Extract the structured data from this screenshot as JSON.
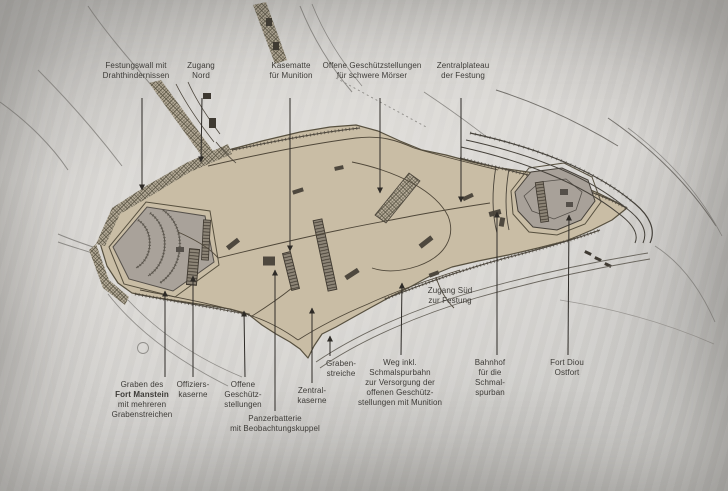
{
  "figure": {
    "kind": "annotated fortress plan",
    "colors": {
      "paper": "#d3d2cf",
      "land": "#c9bda5",
      "fort_fill": "#a8a199",
      "structure_dark": "#4e483e",
      "outline": "#57503f",
      "pointer": "#2e2b27",
      "label_text": "#3e3c38"
    }
  },
  "annotations": {
    "top": [
      {
        "id": "festungswall",
        "lines": [
          "Festungswall mit",
          "Drahthindernissen"
        ]
      },
      {
        "id": "zugang-nord",
        "lines": [
          "Zugang",
          "Nord"
        ]
      },
      {
        "id": "kasematte",
        "lines": [
          "Kasematte",
          "für Munition"
        ]
      },
      {
        "id": "offene-moerser",
        "lines": [
          "Offene Geschützstellungen",
          "für schwere Mörser"
        ]
      },
      {
        "id": "zentralplateau",
        "lines": [
          "Zentralplateau",
          "der Festung"
        ]
      }
    ],
    "bottom": [
      {
        "id": "graben-fort-manstein",
        "lines": [
          "Graben des",
          "Fort Manstein",
          "mit mehreren",
          "Grabenstreichen"
        ]
      },
      {
        "id": "offizierskaserne",
        "lines": [
          "Offiziers-",
          "kaserne"
        ]
      },
      {
        "id": "offene-geschuetz",
        "lines": [
          "Offene",
          "Geschütz-",
          "stellungen"
        ]
      },
      {
        "id": "panzerbatterie",
        "lines": [
          "Panzerbatterie",
          "mit Beobachtungskuppel"
        ]
      },
      {
        "id": "zentralkaserne",
        "lines": [
          "Zentral-",
          "kaserne"
        ]
      },
      {
        "id": "grabenstreiche",
        "lines": [
          "Graben-",
          "streiche"
        ]
      },
      {
        "id": "weg-schmalspurbahn",
        "lines": [
          "Weg inkl.",
          "Schmalspurbahn",
          "zur Versorgung der",
          "offenen Geschütz-",
          "stellungen mit Munition"
        ]
      },
      {
        "id": "bahnhof",
        "lines": [
          "Bahnhof",
          "für die",
          "Schmal-",
          "spurban"
        ]
      },
      {
        "id": "fort-diou",
        "lines": [
          "Fort Diou",
          "Ostfort"
        ]
      }
    ],
    "floating": [
      {
        "id": "zugang-sued",
        "lines": [
          "Zugang Süd",
          "zur Festung"
        ]
      }
    ]
  }
}
